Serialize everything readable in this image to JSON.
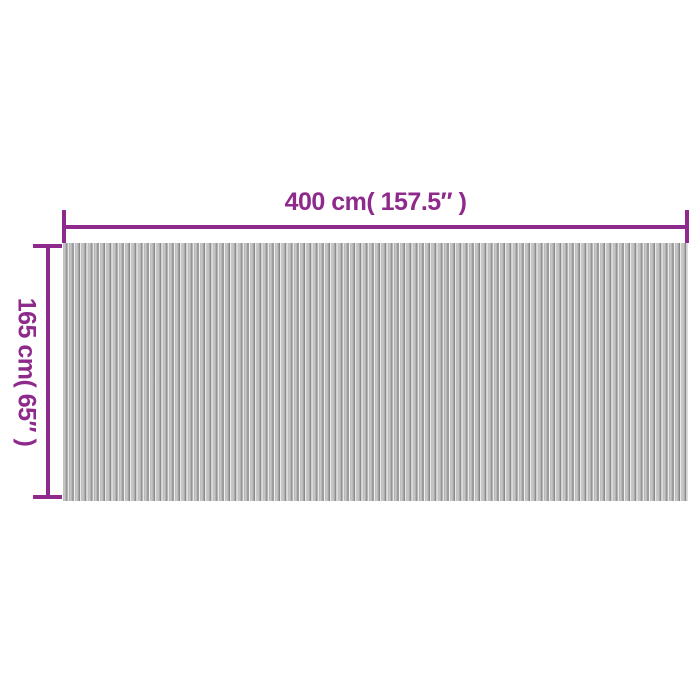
{
  "diagram": {
    "title": "product-dimension-diagram",
    "width_dimension": {
      "label": "400 cm( 157.5″ )"
    },
    "height_dimension": {
      "label": "165 cm( 65″ )"
    },
    "colors": {
      "background": "#ffffff",
      "dimension_line": "#8d2a8c",
      "dimension_text": "#8d2a8c",
      "slat_dark": "#7f7f7f",
      "slat_mid": "#b5b5b5",
      "slat_light": "#f7f7f7"
    }
  }
}
